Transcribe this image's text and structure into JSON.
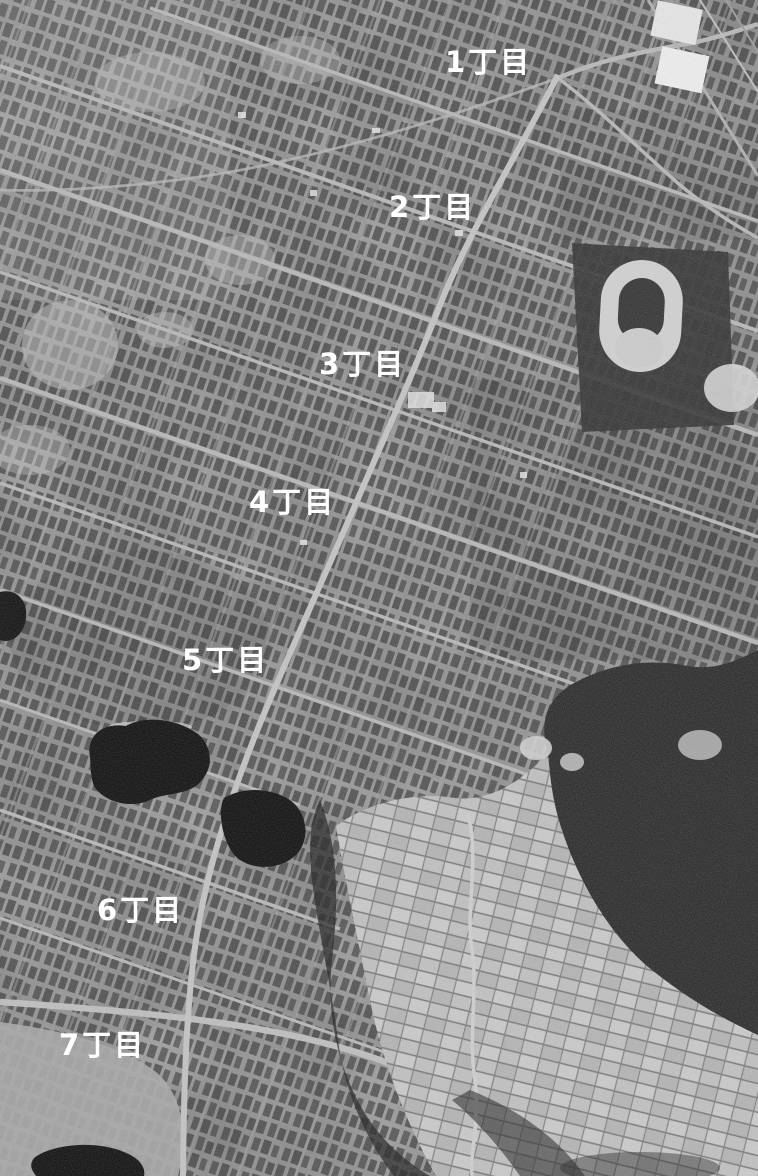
{
  "map": {
    "type": "aerial-photograph",
    "style": "monochrome",
    "labels": [
      {
        "id": "chome-1",
        "text": "1丁目",
        "x": 445,
        "y": 48
      },
      {
        "id": "chome-2",
        "text": "2丁目",
        "x": 389,
        "y": 193
      },
      {
        "id": "chome-3",
        "text": "3丁目",
        "x": 319,
        "y": 350
      },
      {
        "id": "chome-4",
        "text": "4丁目",
        "x": 249,
        "y": 488
      },
      {
        "id": "chome-5",
        "text": "5丁目",
        "x": 182,
        "y": 646
      },
      {
        "id": "chome-6",
        "text": "6丁目",
        "x": 97,
        "y": 896
      },
      {
        "id": "chome-7",
        "text": "7丁目",
        "x": 59,
        "y": 1031
      }
    ],
    "label_style": {
      "color": "#ffffff",
      "font_size_px": 29,
      "font_weight": "bold"
    },
    "features": [
      "dense-row-house-grid",
      "main-diagonal-road",
      "cross-streets",
      "racetrack-oval-park",
      "two-dark-ponds",
      "forest-hill-east",
      "farm-field-patchwork-southeast",
      "railway-corridor-northeast",
      "open-field-southwest",
      "small-pond-bottom-left"
    ],
    "palette": {
      "base": "#7f7f7f",
      "houses": "#1c1c1c",
      "roads": "#c0c0c0",
      "water": "#0b0b0b",
      "forest": "#191919",
      "fields": "#c2c2c2",
      "track": "#d2d2d2",
      "labels": "#ffffff"
    }
  }
}
